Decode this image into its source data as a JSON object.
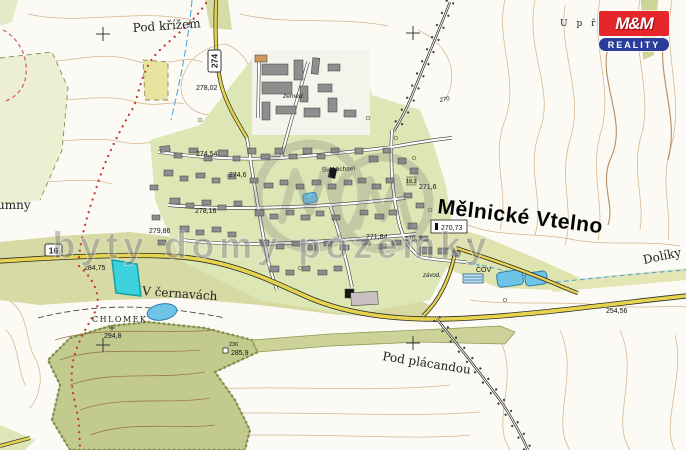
{
  "title": "Mělnické Vtelno",
  "labels": {
    "pod_krizem": "Pod křížem",
    "u_pricem": "U  p ř í",
    "humny": "umny",
    "v_cernavach": "V černavách",
    "chlomek": "CHLOMEK",
    "pod_placandou": "Pod plácandou",
    "doliky": "Dolíky",
    "sv_michael": "Sv. Michael",
    "zemed": "zeměd.",
    "zavod": "závod.",
    "cov": "ČOV",
    "contour_270": "270"
  },
  "roads": {
    "r16": "16",
    "r274": "274"
  },
  "elev": {
    "h278_02": "278,02",
    "h274_54": "274,54",
    "h274_6": "274,6",
    "h278_16": "278,16",
    "h279_86": "279,86",
    "h284_75": "284,75",
    "h294_8": "294,8",
    "h236": "236",
    "h285_9": "285,9",
    "h271_6": "271,6",
    "h18_2": "18,2",
    "h270_73": "270,73",
    "h270_7": "270,7",
    "h271_84": "271,84",
    "h254_56": "254,56"
  },
  "watermark": {
    "text": "byty domy pozemky"
  },
  "logo": {
    "brand": "M&M",
    "tagline": "REALITY"
  },
  "colors": {
    "road_yellow": "#e6d44e",
    "water_blue": "#6ec4e6",
    "highlight_parcel": "#3cd3de",
    "forest_green": "#c3ca8e",
    "field_green": "#dde4b2",
    "contour_tan": "#cfae83",
    "trail_red": "#c23b2e",
    "logo_red": "#e5262b",
    "logo_blue": "#2a3d9b"
  }
}
